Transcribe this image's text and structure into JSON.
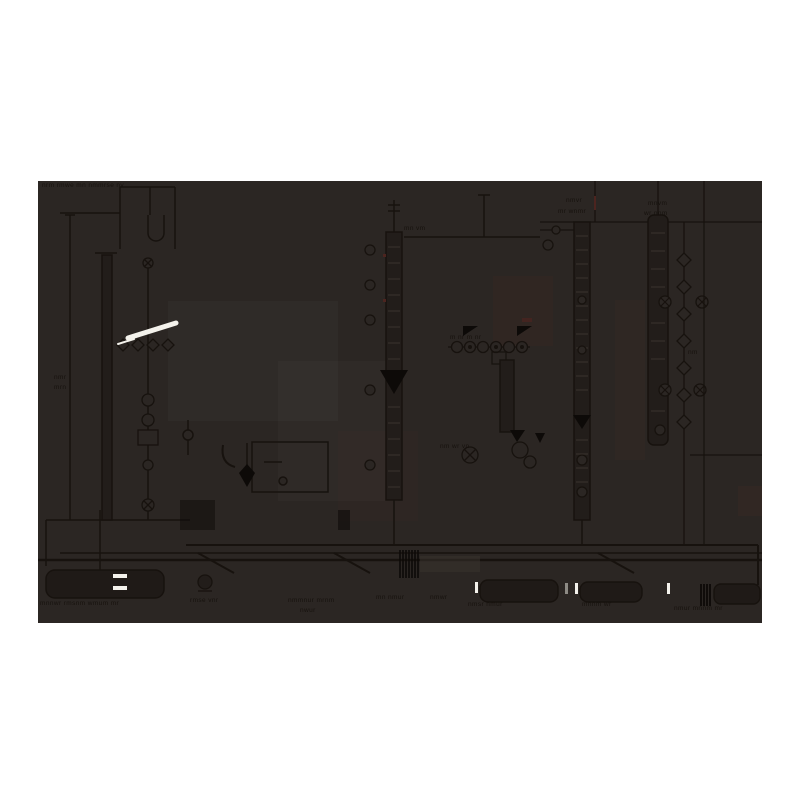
{
  "colors": {
    "page_bg": "#ffffff",
    "canvas_bg": "#2b2623",
    "ink": "#17120e",
    "ink_soft": "#3a332e",
    "fill_dark": "#221d1a",
    "black_fill": "#0d0a08",
    "vessel_fill": "#1f1a17",
    "white_accent": "#f4f2ec",
    "gray_accent": "#8d8a84",
    "red_accent": "#4c241f"
  },
  "labels": {
    "title": "nrm rmwe mn nmmrse nv",
    "top_mid": "mn vm",
    "colE_line1": "nmvr",
    "colE_line2": "mr wnmr",
    "colF_line1": "mnvm",
    "colF_line2": "wr nnm",
    "left1": "nmr",
    "left2": "mrn",
    "exch": "m nr m nr",
    "cluster": "nm wr vn",
    "drum1_label": "mnnwr rmsnm wmum mr",
    "pump1_label": "rmse vnr",
    "mid1": "nmmnur mrnm",
    "mid2": "nwur",
    "mid3": "mn nmur",
    "mid4": "nmwr",
    "v2_label": "nmsr nmur",
    "v3_label": "mnnm wr",
    "v4_label": "nmur mnnm mr",
    "right_small": "nm"
  }
}
